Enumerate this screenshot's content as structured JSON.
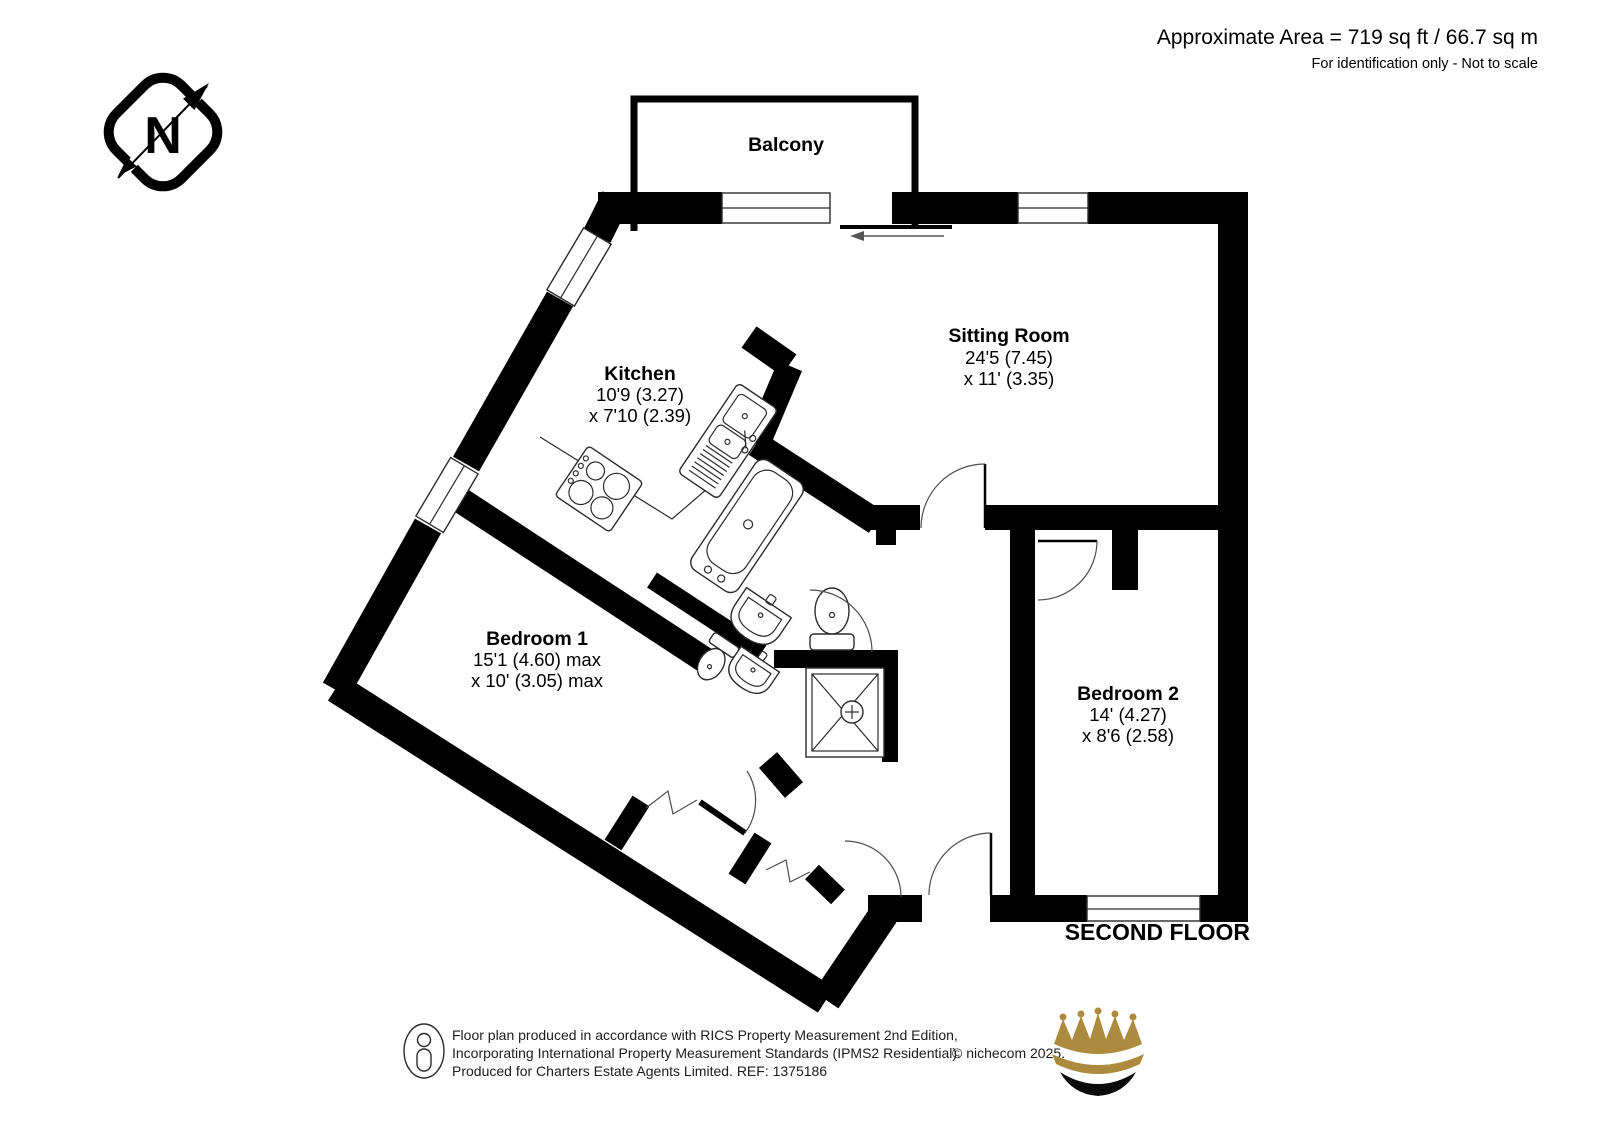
{
  "header": {
    "area": "Approximate Area = 719 sq ft / 66.7 sq m",
    "disclaimer": "For identification only - Not to scale"
  },
  "compass": {
    "letter": "N"
  },
  "rooms": {
    "balcony": {
      "name": "Balcony"
    },
    "sitting_room": {
      "name": "Sitting Room",
      "dim1": "24'5 (7.45)",
      "dim2": "x 11' (3.35)"
    },
    "kitchen": {
      "name": "Kitchen",
      "dim1": "10'9 (3.27)",
      "dim2": "x 7'10 (2.39)"
    },
    "bedroom1": {
      "name": "Bedroom 1",
      "dim1": "15'1 (4.60) max",
      "dim2": "x 10' (3.05) max"
    },
    "bedroom2": {
      "name": "Bedroom 2",
      "dim1": "14' (4.27)",
      "dim2": "x 8'6 (2.58)"
    }
  },
  "floor_label": "SECOND FLOOR",
  "footer": {
    "line1": "Floor plan produced in accordance with RICS Property Measurement 2nd Edition,",
    "line2": "Incorporating International Property Measurement Standards (IPMS2 Residential).",
    "copyright": "© nichecom 2025.",
    "line3": "Produced for Charters Estate Agents Limited.   REF: 1375186"
  },
  "colors": {
    "walls": "#000000",
    "crown_gold": "#ac8b3e",
    "background": "#ffffff"
  }
}
